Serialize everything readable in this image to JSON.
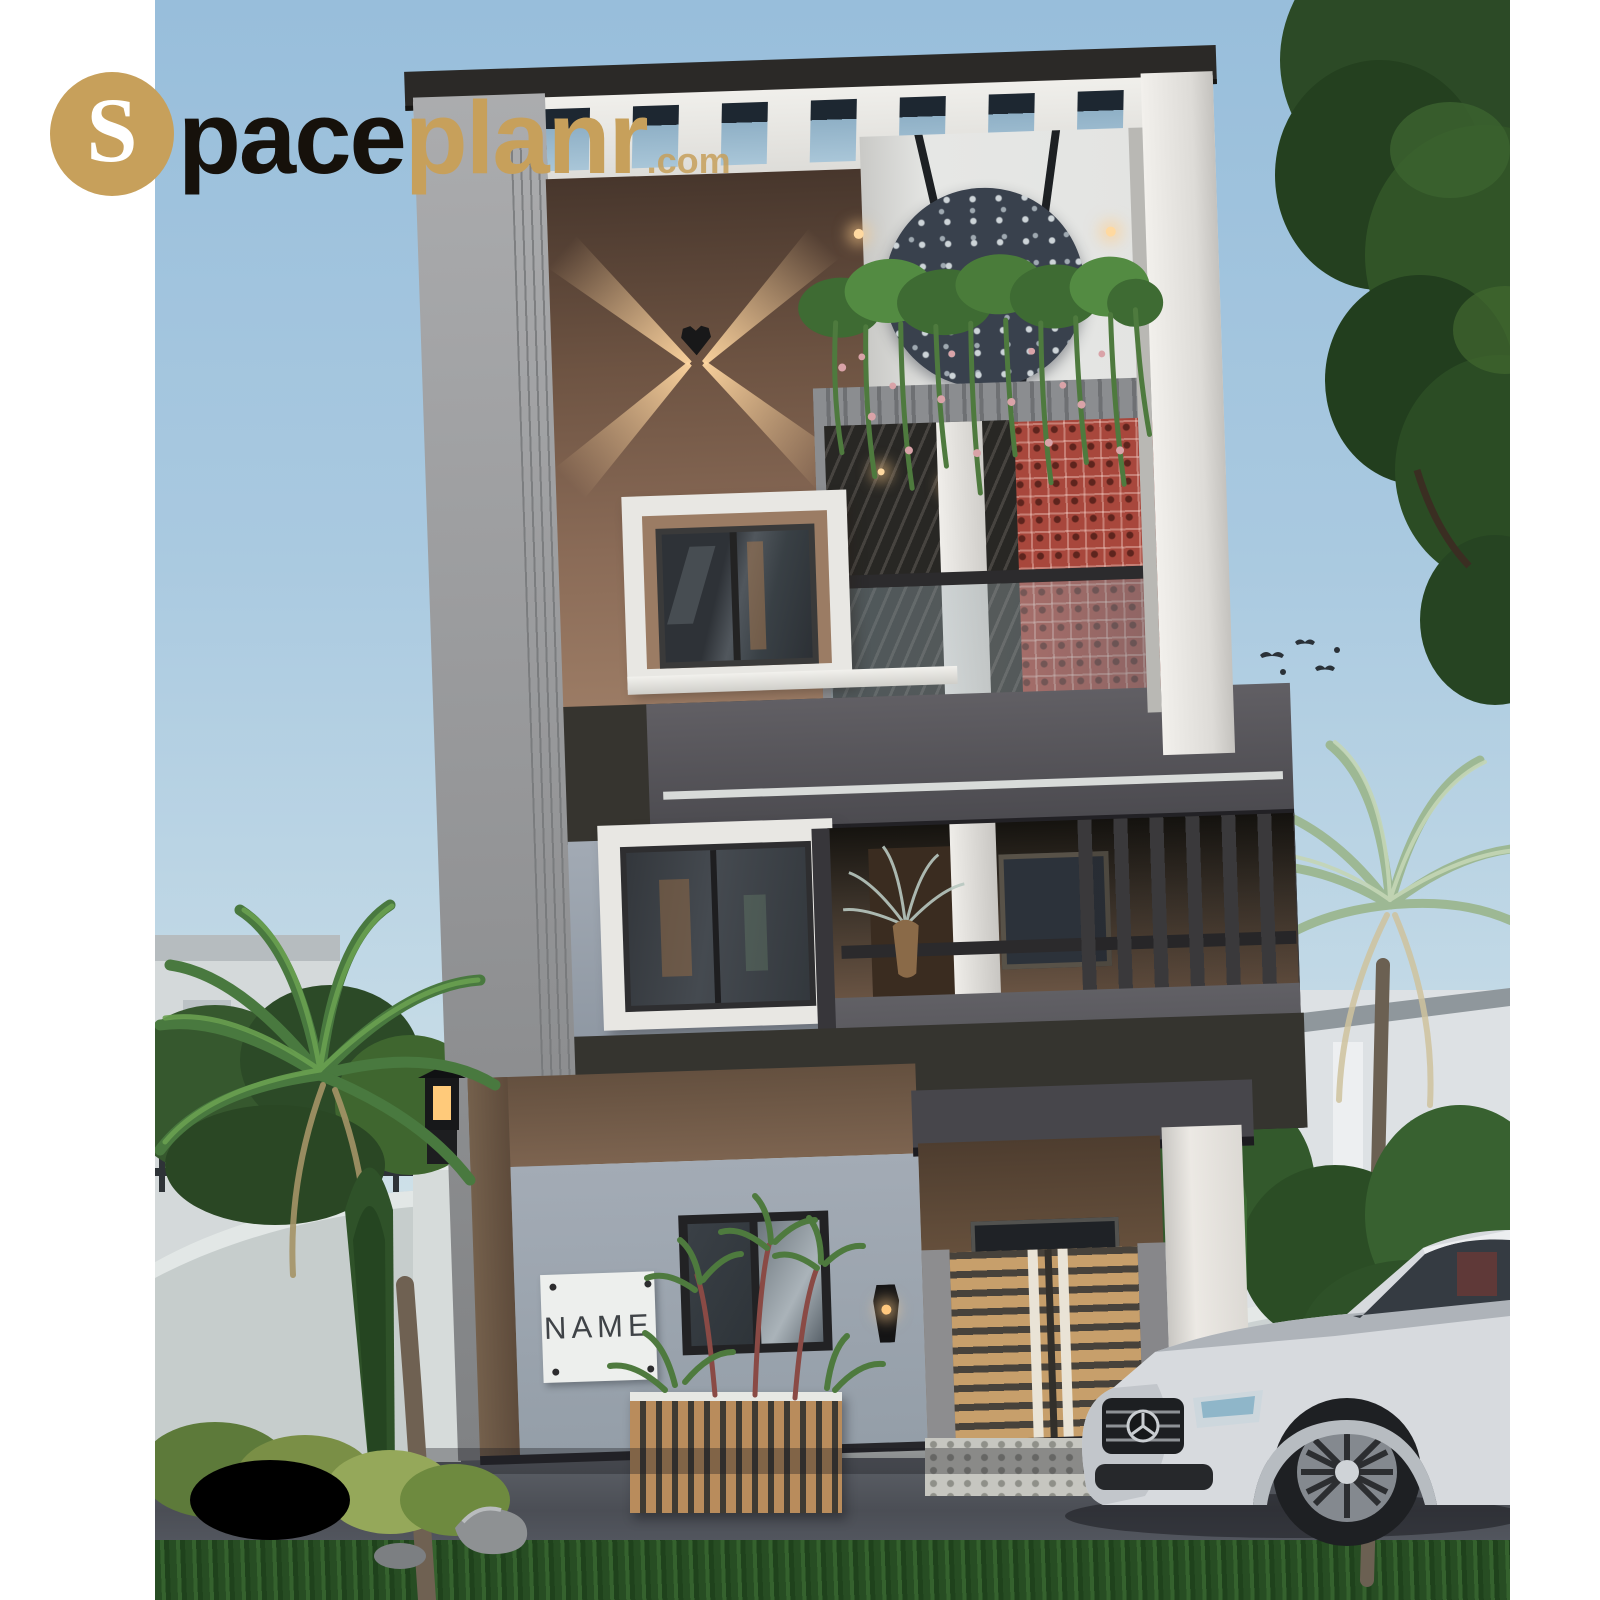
{
  "logo": {
    "badge_letter": "S",
    "name_black": "pace",
    "name_gold": "planr",
    "tld": ".com"
  },
  "house": {
    "name_plate": "NAME"
  },
  "palette": {
    "logo_gold": "#c7a05b",
    "logo_black": "#16110b",
    "sky_top": "#98bedb",
    "sky_horizon": "#dde9ea",
    "white_trim": "#e9e8e4",
    "side_wall_grey": "#97989a",
    "wall_brown": "#7b5f4c",
    "charcoal_band": "#36342f",
    "balcony_grey": "#545358",
    "wall_blue_grey": "#98a1ab",
    "jali_red": "#a8473c",
    "gate_wood": "#c79f6b",
    "plant_green": "#49793f",
    "pale_palm": "#a3bd9a",
    "asphalt": "#53565c",
    "grass": "#2b5227",
    "car_white": "#d7dade"
  },
  "icons": {
    "wall_light": "heart-light",
    "car_badge": "mercedes-star",
    "panel": "circular-leaf-jali"
  }
}
